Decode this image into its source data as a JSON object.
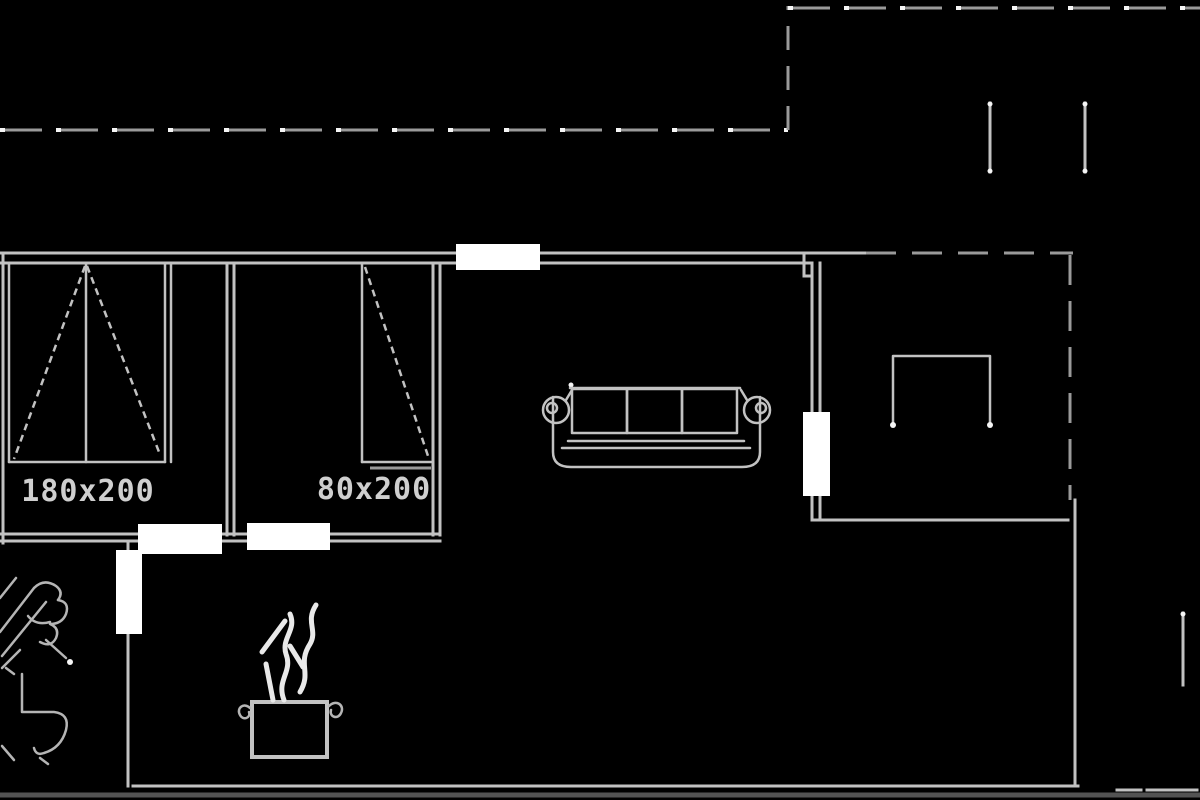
{
  "app": {
    "type": "cad-floor-plan-view",
    "description": "black-background CAD floor plan drawing, plan view"
  },
  "colors": {
    "background": "#000000",
    "wall": "#c2c2c2",
    "wall_dim": "#9a9a9a",
    "wall_bright": "#f5f5f5",
    "opening": "#ffffff",
    "sketch": "#b5b5b5",
    "steam": "#e9e9e9",
    "label_text": "#cfcfcf",
    "baseline": "#535353"
  },
  "labels": {
    "wardrobe_large": "180x200",
    "wardrobe_small": "80x200"
  },
  "symbols": [
    "wardrobe-double-door-icon",
    "wardrobe-single-door-icon",
    "sofa-icon",
    "side-table-icon",
    "cooking-pot-icon",
    "steam-icon",
    "sink-sketch-icon",
    "toilet-sketch-icon",
    "door-opening-block",
    "window-mark"
  ]
}
